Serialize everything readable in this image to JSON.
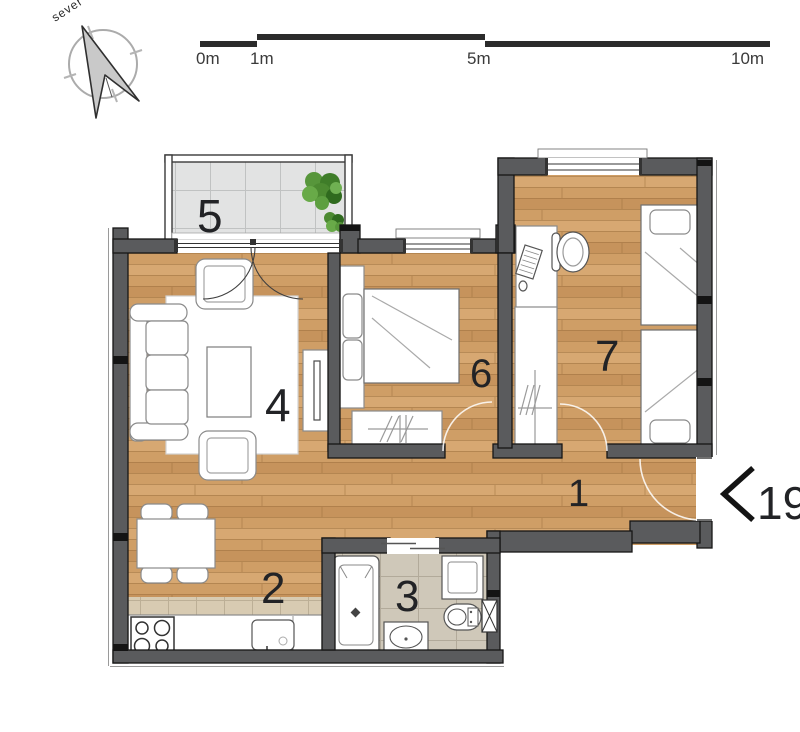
{
  "compass": {
    "label": "sever"
  },
  "scale_bar": {
    "tick_labels": [
      "0m",
      "1m",
      "5m",
      "10m"
    ]
  },
  "entrance": {
    "unit_number": "19"
  },
  "rooms": [
    {
      "number": "1",
      "name": "hallway"
    },
    {
      "number": "2",
      "name": "kitchen-dining"
    },
    {
      "number": "3",
      "name": "bathroom"
    },
    {
      "number": "4",
      "name": "living-room"
    },
    {
      "number": "5",
      "name": "terrace"
    },
    {
      "number": "6",
      "name": "bedroom"
    },
    {
      "number": "7",
      "name": "bedroom"
    }
  ],
  "icons": {
    "compass_arrow": "north-dart",
    "entrance_chevron": "left-chevron"
  },
  "colors": {
    "wall": "#5a5b5d",
    "wood_floor": "#cf9e66",
    "terrace_tile": "#e2e3e3",
    "bathroom_tile": "#cfc8b9",
    "backsplash_tile": "#d8cbb2",
    "plant": "#4e8f35",
    "line": "#161616"
  }
}
